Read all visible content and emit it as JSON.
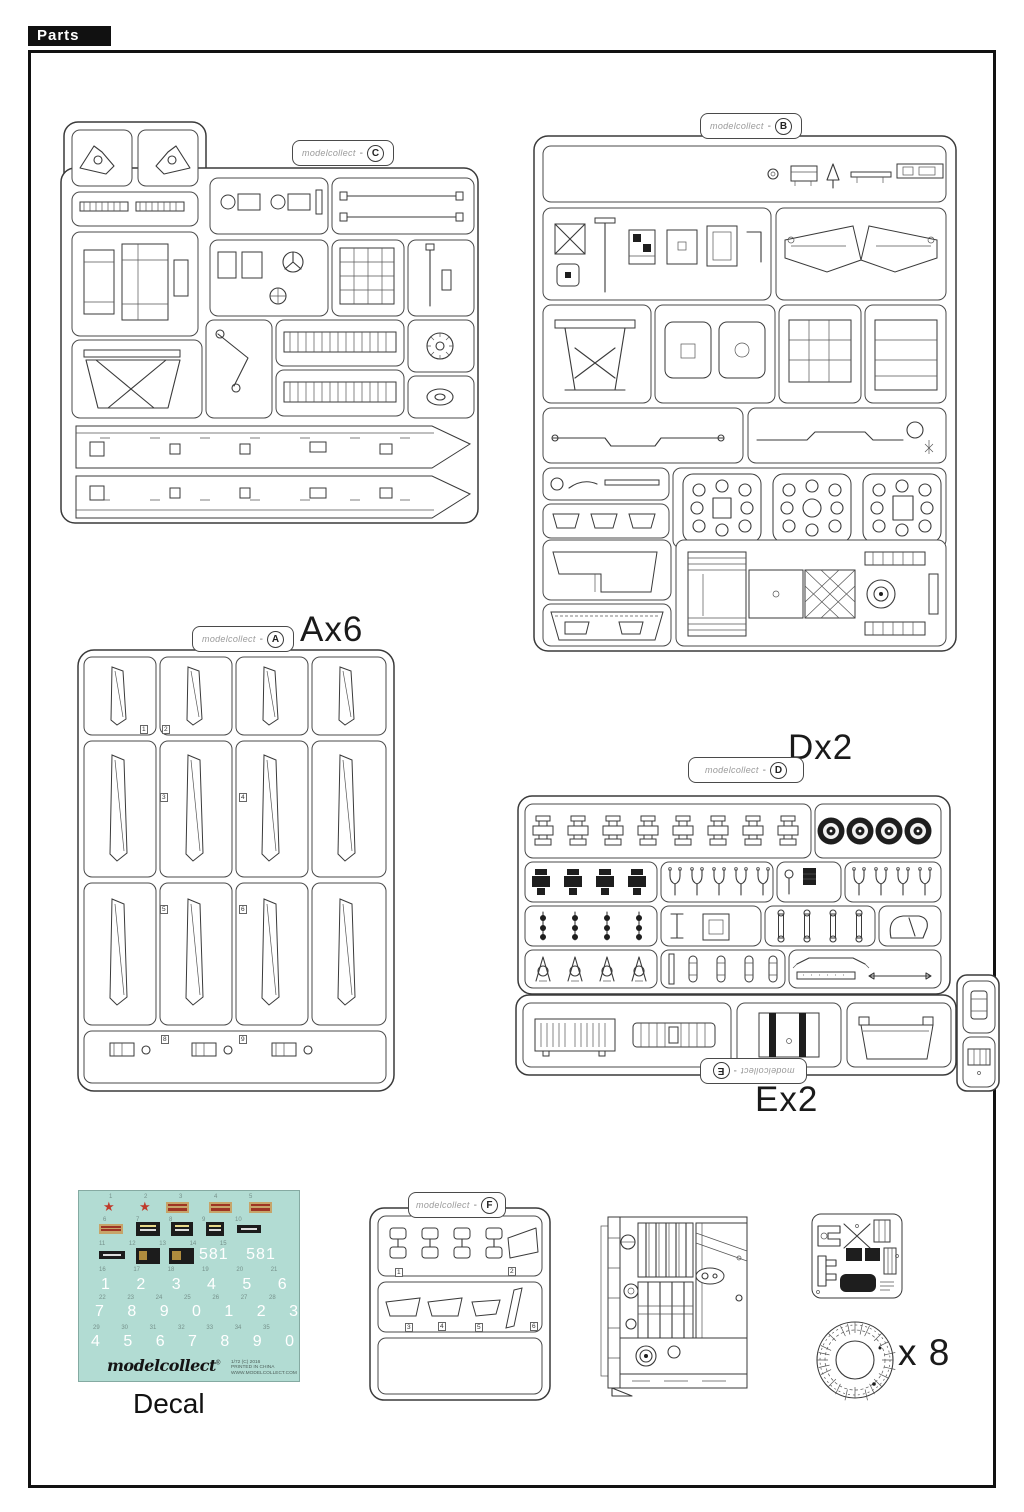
{
  "header": {
    "title": "Parts"
  },
  "brand": "modelcollect",
  "tab_separator": "-",
  "sprues": {
    "c": {
      "letter": "C"
    },
    "b": {
      "letter": "B"
    },
    "a": {
      "letter": "A",
      "qty": "Ax6",
      "part_numbers": [
        "1",
        "2",
        "3",
        "4",
        "5",
        "6",
        "8",
        "9"
      ]
    },
    "d": {
      "letter": "D",
      "qty": "Dx2"
    },
    "e": {
      "letter": "E",
      "qty": "Ex2"
    },
    "f": {
      "letter": "F",
      "part_numbers": [
        "1",
        "2",
        "3",
        "4",
        "5",
        "6"
      ]
    }
  },
  "track_link_ring": {
    "qty": "x 8"
  },
  "decal": {
    "caption": "Decal",
    "star": "★",
    "indices": [
      "1 2 3 4 5",
      "6 7 8 9 10",
      "11 12 13 14 15",
      "16 17 18 19 20 21",
      "22 23 24 25 26 27 28",
      "29 30 31 32 33 34 35"
    ],
    "numbers": [
      "581  581",
      "1 2 3 4 5 6",
      "7 8 9 0 1 2 3",
      "4 5 6 7 8 9 0"
    ],
    "logo": "modelcollect",
    "registered": "®",
    "fine_print": [
      "1/72 (C) 2016",
      "PRINTED IN CHINA",
      "WWW.MODELCOLLECT.COM"
    ]
  }
}
